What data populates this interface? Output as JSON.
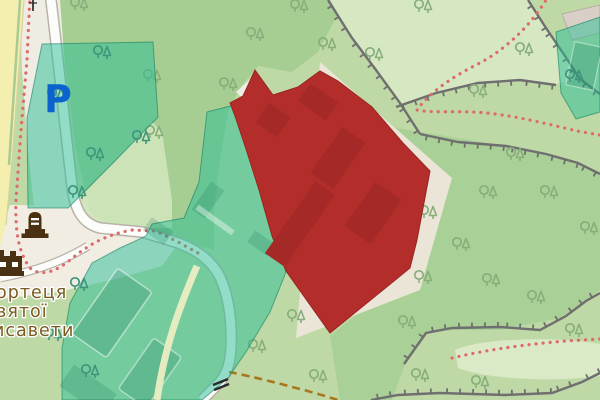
{
  "map": {
    "labels": {
      "parking": "P",
      "place_lines": [
        "ортеця",
        "вятої",
        "исавети"
      ]
    },
    "icons": [
      "parking-label",
      "memorial-icon",
      "castle-icon",
      "gate-icon",
      "utility-pole-icon",
      "tree-icons"
    ],
    "colors": {
      "base_green": "#BED9A6",
      "forest_green": "#A6CE92",
      "forest_green_right": "#A9D096",
      "light_grass": "#D6E8C2",
      "pale_grass": "#DAEAC6",
      "beige_ground": "#EFECE4",
      "plaza_beige": "#F1EDE3",
      "beige_scree": "#EBE5D7",
      "yellow_road": "#F4EFAF",
      "road_fill": "#FCFCFA",
      "road_casing": "#B9B3A8",
      "embankment_gray": "#6F6F6F",
      "path_red_dots": "#DD6B6B",
      "track_orange": "#A9771E",
      "rampart_path": "#EAEDC2",
      "highlight_teal": "rgba(40,190,150,0.5)",
      "highlight_teal_border": "rgba(10,120,90,0.55)",
      "teal_building": "rgba(10,105,75,0.18)",
      "red_zone": "#B32E2B",
      "red_zone_border": "#992523",
      "red_zone_building": "#A52A27",
      "building_gray": "#D8D0C6",
      "building_gray_border": "#BAAEA3",
      "tree_green": "#87AE7B",
      "tree_teal": "#3F947A",
      "label_brown": "#7A5A1E",
      "parking_blue": "#0B63CE",
      "icon_brown": "#4A3112",
      "gate_black": "#2A2A2A"
    }
  }
}
